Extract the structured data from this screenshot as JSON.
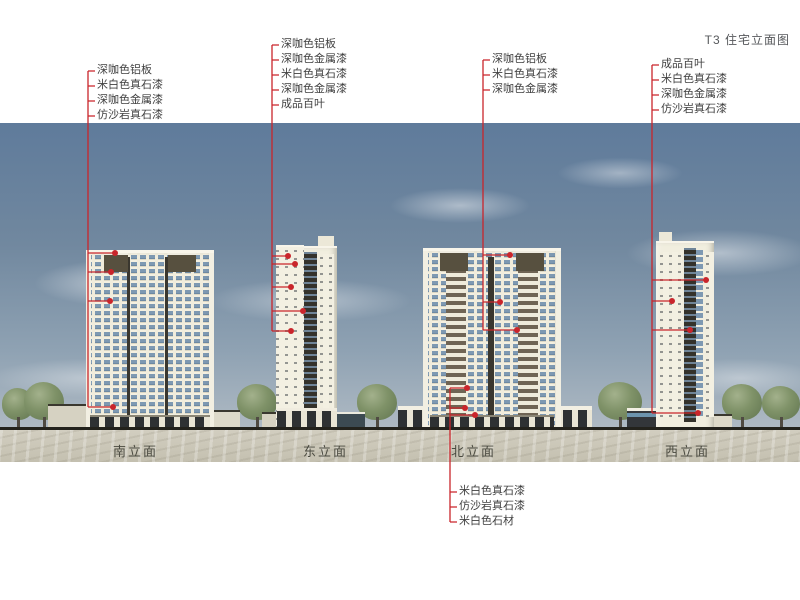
{
  "title": "T3 住宅立面图",
  "elevation_labels": [
    "南立面",
    "东立面",
    "北立面",
    "西立面"
  ],
  "annotation_groups": {
    "south": [
      "深咖色铝板",
      "米白色真石漆",
      "深咖色金属漆",
      "仿沙岩真石漆"
    ],
    "east": [
      "深咖色铝板",
      "深咖色金属漆",
      "米白色真石漆",
      "深咖色金属漆",
      "成品百叶"
    ],
    "north_upper": [
      "深咖色铝板",
      "米白色真石漆",
      "深咖色金属漆"
    ],
    "west": [
      "成品百叶",
      "米白色真石漆",
      "深咖色金属漆",
      "仿沙岩真石漆"
    ],
    "north_lower": [
      "米白色真石漆",
      "仿沙岩真石漆",
      "米白色石材"
    ]
  },
  "colors": {
    "leader_red": "#c9252b",
    "facade_cream": "#f0ecdc",
    "window_blue": "#7e99b2",
    "panel_dark": "#57503f",
    "sky_top": "#5f7b9b",
    "ground_band": "#cbc7b8",
    "ground_line": "#23221c"
  }
}
